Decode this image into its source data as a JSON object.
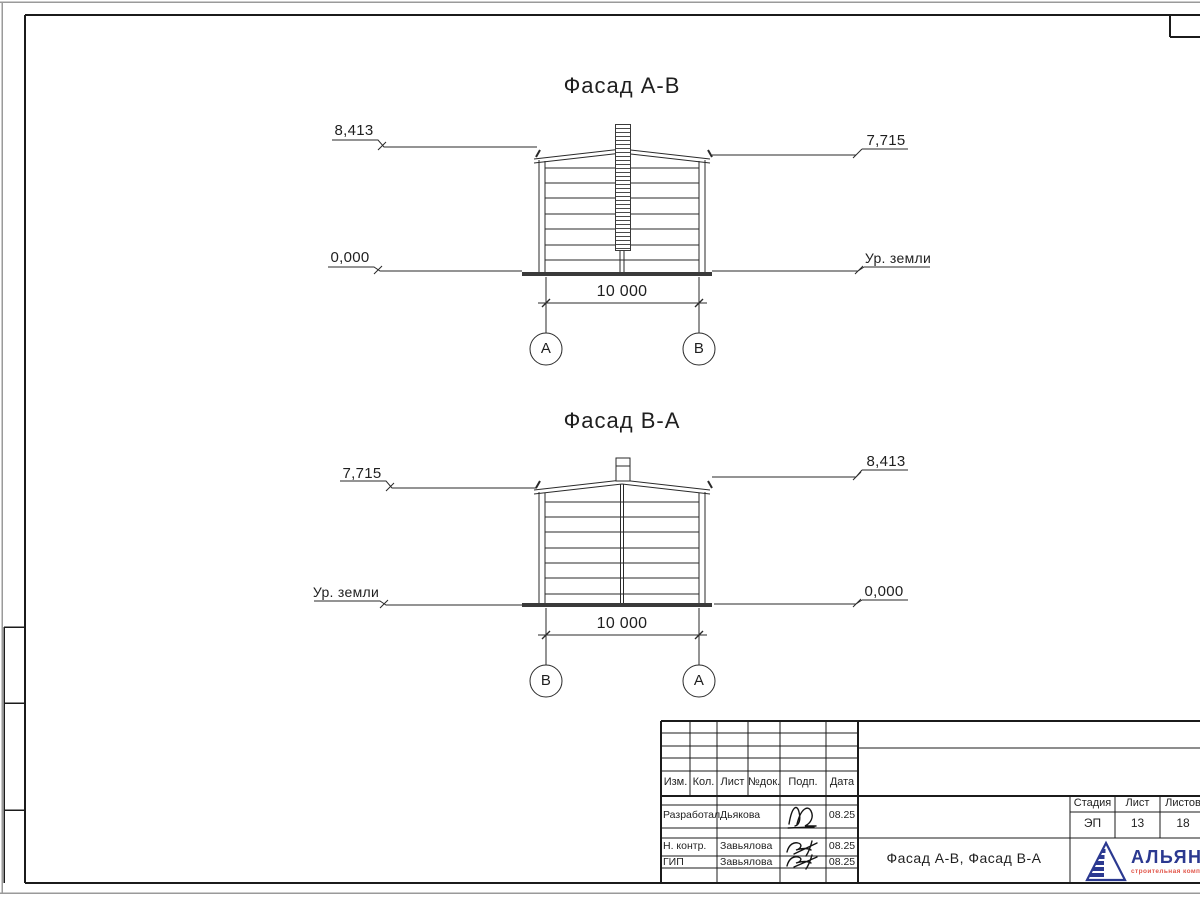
{
  "sheet": {
    "facades": [
      {
        "title": "Фасад А-В",
        "elev_left_top": "8,413",
        "elev_right_top": "7,715",
        "elev_left_bottom": "0,000",
        "elev_right_bottom": "Ур. земли",
        "dimension": "10 000",
        "axis_left": "А",
        "axis_right": "В"
      },
      {
        "title": "Фасад В-А",
        "elev_left_top": "7,715",
        "elev_right_top": "8,413",
        "elev_left_bottom": "Ур. земли",
        "elev_right_bottom": "0,000",
        "dimension": "10 000",
        "axis_left": "В",
        "axis_right": "А"
      }
    ],
    "title_block": {
      "change_cols": [
        "Изм.",
        "Кол.",
        "Лист",
        "№док.",
        "Подп.",
        "Дата"
      ],
      "sign_rows": [
        {
          "role": "Разработал",
          "name": "Дьякова",
          "date": "08.25"
        },
        {
          "role": "Н. контр.",
          "name": "Завьялова",
          "date": "08.25"
        },
        {
          "role": "ГИП",
          "name": "Завьялова",
          "date": "08.25"
        }
      ],
      "doc_title": "Фасад А-В, Фасад В-А",
      "stage": {
        "label": "Стадия",
        "value": "ЭП"
      },
      "sheet_no": {
        "label": "Лист",
        "value": "13"
      },
      "sheets_total": {
        "label": "Листов",
        "value": "18"
      },
      "company": {
        "name": "АЛЬЯНС",
        "tagline": "строительная компания"
      },
      "colors": {
        "brand_blue": "#2b3990",
        "brand_red": "#e2574b",
        "line": "#1f1f1f"
      }
    }
  }
}
